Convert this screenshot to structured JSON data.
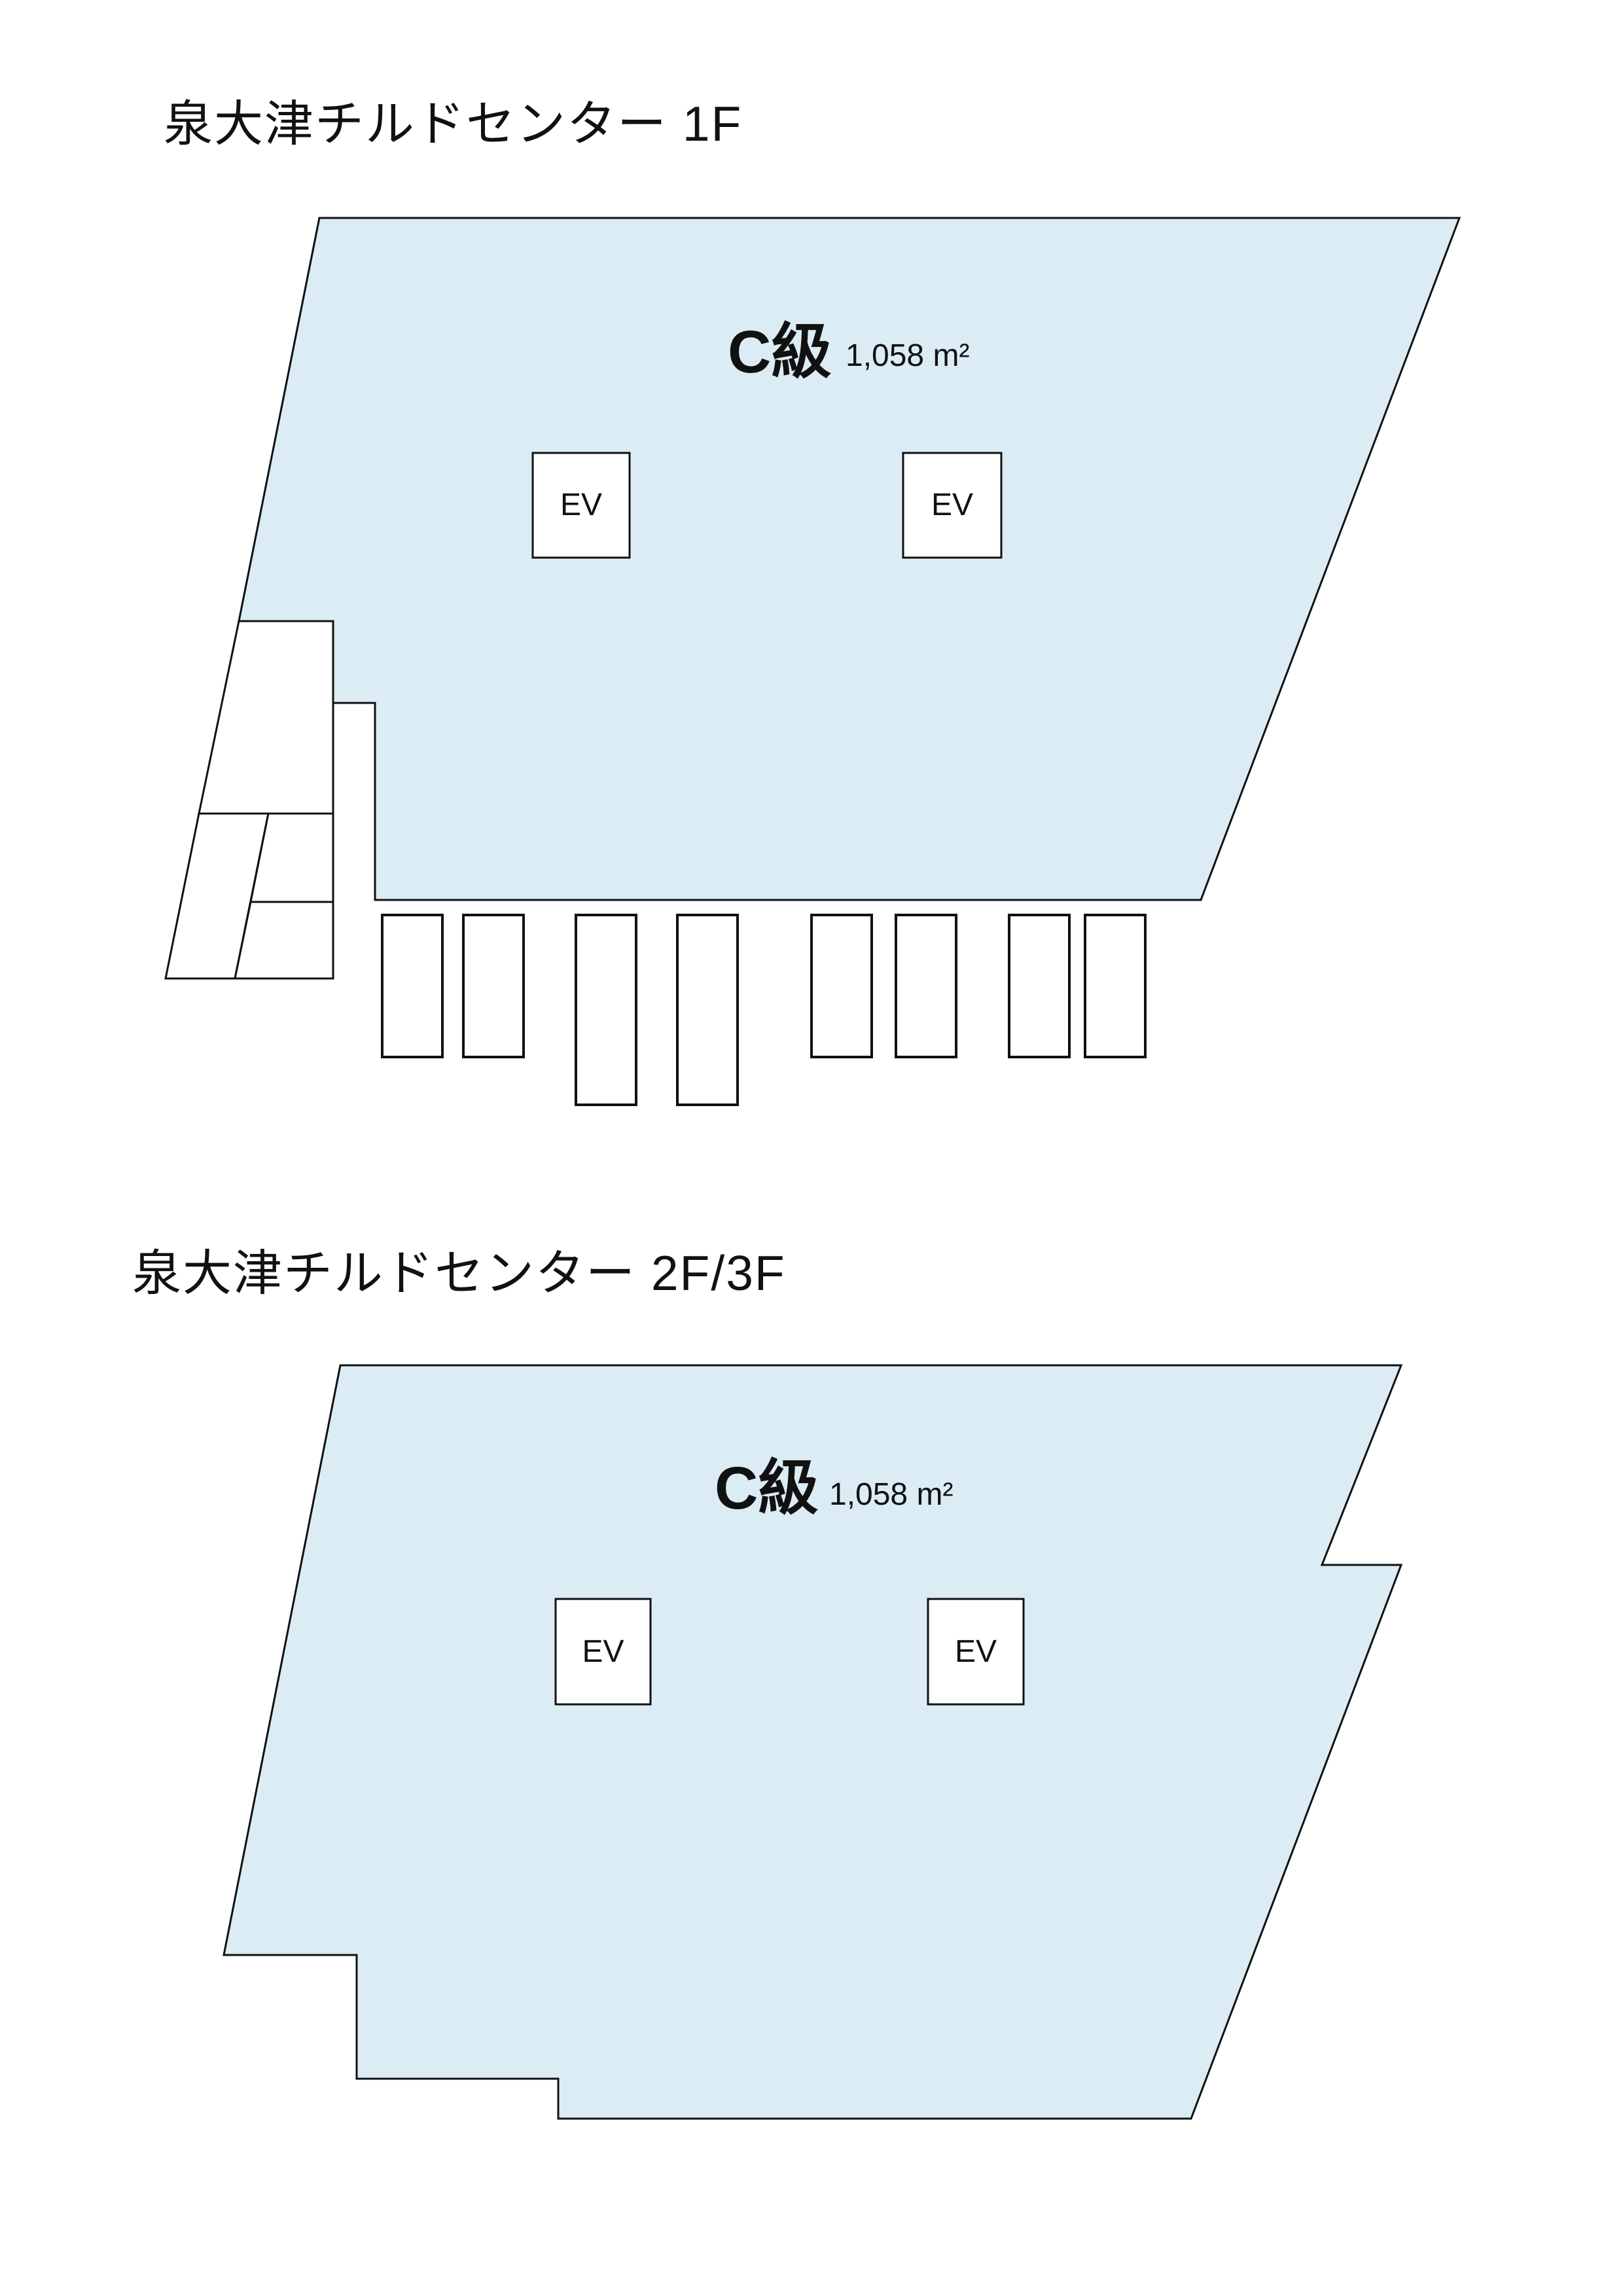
{
  "document": {
    "background": "#ffffff",
    "floor_fill_color": "#dbecf5",
    "line_color": "#111111"
  },
  "floor1": {
    "title": "泉大津チルドセンター 1F",
    "grade_label": "C級",
    "area_label": "1,058 m²",
    "ev_labels": [
      "EV",
      "EV"
    ]
  },
  "floor2": {
    "title": "泉大津チルドセンター 2F/3F",
    "grade_label": "C級",
    "area_label": "1,058 m²",
    "ev_labels": [
      "EV",
      "EV"
    ]
  }
}
